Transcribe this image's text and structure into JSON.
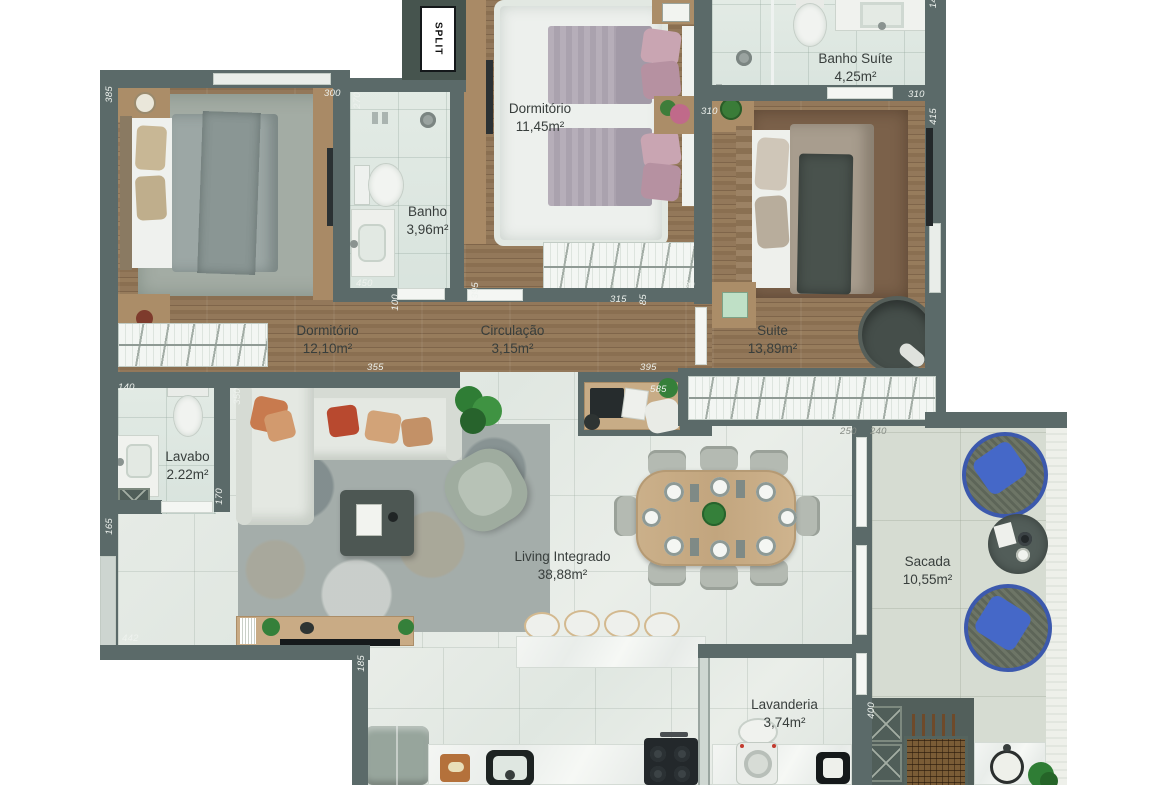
{
  "plan_title": "Apartment floor plan",
  "rooms": {
    "dormitorio2": {
      "name": "Dormitório",
      "area": "11,45m²"
    },
    "banho_suite": {
      "name": "Banho Suíte",
      "area": "4,25m²"
    },
    "banho": {
      "name": "Banho",
      "area": "3,96m²"
    },
    "dormitorio1": {
      "name": "Dormitório",
      "area": "12,10m²"
    },
    "circulacao": {
      "name": "Circulação",
      "area": "3,15m²"
    },
    "suite": {
      "name": "Suite",
      "area": "13,89m²"
    },
    "lavabo": {
      "name": "Lavabo",
      "area": "2.22m²"
    },
    "living": {
      "name": "Living Integrado",
      "area": "38,88m²"
    },
    "sacada": {
      "name": "Sacada",
      "area": "10,55m²"
    },
    "lavanderia": {
      "name": "Lavanderia",
      "area": "3,74m²"
    }
  },
  "equipment": {
    "split": "SPLIT"
  },
  "dimensions": {
    "d385": "385",
    "d300": "300",
    "d270": "270",
    "d14": "14",
    "d310a": "310",
    "d310b": "310",
    "d415": "415",
    "d450": "450",
    "d100": "100",
    "d395a": "395",
    "d315": "315",
    "d85": "85",
    "d290": "290",
    "d355": "355",
    "d395b": "395",
    "d585": "585",
    "d250": "250",
    "d240": "240",
    "d140": "140",
    "d350": "350",
    "d170": "170",
    "d165": "165",
    "d442": "442",
    "d185": "185",
    "d400": "400"
  },
  "colors": {
    "wall": "#5b6a69",
    "wood": "#8d7254",
    "bath_tile": "#dde6e0",
    "living_floor": "#e5eae5",
    "sacada_floor": "#d6dcd2",
    "accent_blue": "#4568c8"
  }
}
